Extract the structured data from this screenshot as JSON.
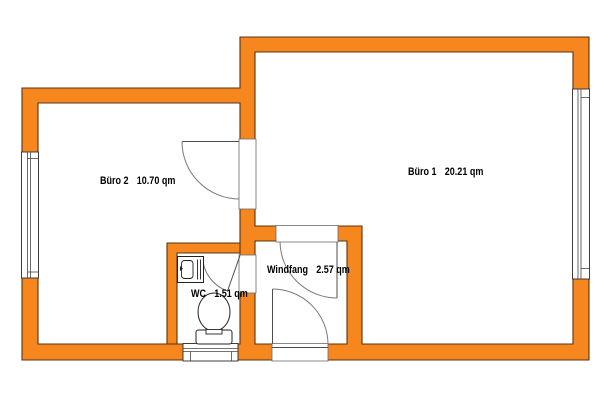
{
  "plan": {
    "rooms": [
      {
        "id": "buero2",
        "name": "Büro 2",
        "area": "10.70 qm"
      },
      {
        "id": "buero1",
        "name": "Büro 1",
        "area": "20.21 qm"
      },
      {
        "id": "windfang",
        "name": "Windfang",
        "area": "2.57 qm"
      },
      {
        "id": "wc",
        "name": "WC",
        "area": "1.51 qm"
      }
    ],
    "fixtures": [
      {
        "icon": "toilet-icon"
      },
      {
        "icon": "sink-icon"
      }
    ],
    "openings": [
      {
        "icon": "window-icon",
        "location": "left-wall"
      },
      {
        "icon": "window-icon",
        "location": "right-wall"
      },
      {
        "icon": "window-icon",
        "location": "wc-bottom-wall"
      },
      {
        "icon": "door-swing-icon",
        "location": "buero2"
      },
      {
        "icon": "door-swing-icon",
        "location": "wc"
      },
      {
        "icon": "door-swing-icon",
        "location": "windfang-top"
      },
      {
        "icon": "door-swing-icon",
        "location": "entrance-bottom"
      }
    ],
    "colors": {
      "wall_fill": "#F6871F",
      "wall_outline": "#5A330F",
      "line_dark": "#2B2B2B",
      "line_gray": "#7A7A7A",
      "text": "#000000",
      "background": "#FFFFFF"
    }
  }
}
